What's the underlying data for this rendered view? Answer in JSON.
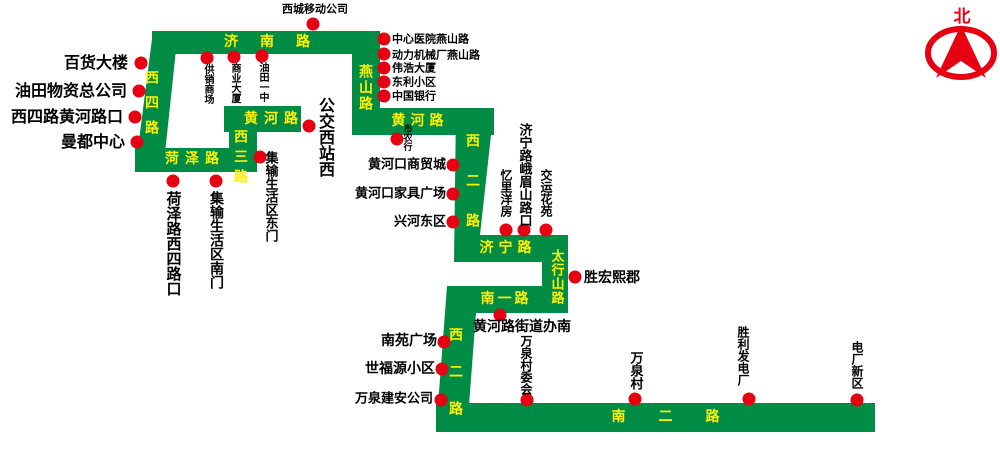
{
  "compass": {
    "north_label": "北"
  },
  "colors": {
    "road_green": "#008C45",
    "stop_dot_red": "#E60012",
    "road_label_yellow": "#FFF100",
    "stop_label_black": "#000000",
    "compass_red": "#E60012",
    "background": "#FFFFFF"
  },
  "roads": {
    "jinan": "济南路",
    "xisi": "西四路",
    "heze": "菏泽路",
    "xisan": "西三路",
    "huanghe_west": "黄河路",
    "yanshan": "燕山路",
    "huanghe_east": "黄河路",
    "xier_north": "西二路",
    "jining": "济宁路",
    "taihangshan": "太行山路",
    "nanyi": "南一路",
    "xier_south": "西二路",
    "naner": "南二路"
  },
  "stops": {
    "xicheng_yidong_gongsi": "西城移动公司",
    "baihuo_dalou": "百货大楼",
    "youtian_wuzi_zonggongsi": "油田物资总公司",
    "xisilu_huanghe_lukou": "西四路黄河路口",
    "mandu_zhongxin": "曼都中心",
    "gongxiao_shangchang": "供销商场",
    "shangye_dasha": "商业大厦",
    "youtian_yizhong": "油田一中",
    "hezelu_xisilu_kou": "荷泽路西四路口",
    "jishu_shenghuoqu_nanmen": "集输生活区南门",
    "jishu_shenghuoqu_dongmen": "集输生活区东门",
    "gongjiao_xizhan_xi": "公交西站西",
    "zhongxin_yiyuan_yanshanlu": "中心医院燕山路",
    "dongli_jixiechang_yanshanlu": "动力机械厂燕山路",
    "weihao_dasha": "伟浩大厦",
    "dongli_xiaoqu": "东利小区",
    "zhongguo_yinhang": "中国银行",
    "shi_nong_hang": "市农行",
    "huanghekou_shangmaocheng": "黄河口商贸城",
    "huanghekou_jiaju_guangchang": "黄河口家具广场",
    "xinghe_dongqu": "兴河东区",
    "yili_yangfang": "忆里洋房",
    "jininglu_emeishan_lukou": "济宁路峨眉山路口",
    "jiaoyun_huayuan": "交运花苑",
    "shenghong_xijun": "胜宏熙郡",
    "huanghelu_jiedaoban_nan": "黄河路街道办南",
    "nanyuan_guangchang": "南苑广场",
    "shifuyuan_xiaoqu": "世福源小区",
    "wanquan_jianan_gongsi": "万泉建安公司",
    "wanquancun_weihui": "万泉村委会",
    "wanquancun": "万泉村",
    "shengli_fadianchang": "胜利发电厂",
    "dianchang_xinqu": "电厂新区"
  }
}
